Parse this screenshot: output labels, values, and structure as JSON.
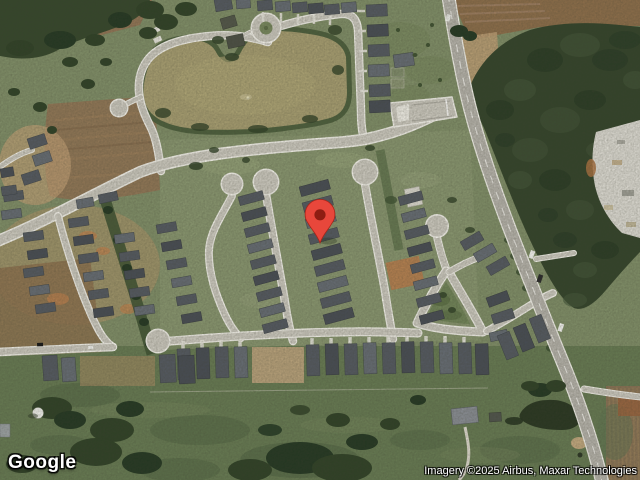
{
  "map": {
    "view": "satellite",
    "marker": {
      "x": 320,
      "y": 243,
      "color": "#E8473B",
      "inner_color": "#8E1D12",
      "outline_color": "#A82519"
    },
    "logo_text": "Google",
    "attribution_text": "Imagery ©2025 Airbus, Maxar Technologies",
    "palette": {
      "grass": "#7E8C66",
      "pasture": "#657851",
      "forest": "#33432A",
      "pond_water": "#A49B6F",
      "road": "#C9C6BC",
      "road_casing": "#EFEDE6",
      "highway": "#B3B0A8",
      "roof_dark": "#53585F",
      "dirt_brown": "#8F7354",
      "dirt_tan": "#C4A47A",
      "orange_dirt": "#B87A4A",
      "quarry": "#D8D6CE"
    }
  }
}
